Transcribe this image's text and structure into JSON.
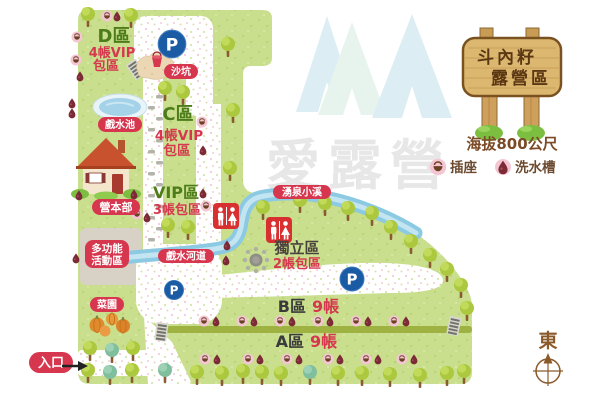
{
  "map": {
    "zone_d": {
      "name": "D區",
      "line1": "4帳VIP",
      "line2": "包區"
    },
    "zone_c": {
      "name": "C區",
      "line1": "4帳VIP",
      "line2": "包區"
    },
    "zone_vip": {
      "name": "VIP區",
      "line1": "3帳包區"
    },
    "zone_indep": {
      "name": "獨立區",
      "line1": "2帳包區"
    },
    "zone_b": {
      "name": "B區",
      "count": "9帳"
    },
    "zone_a": {
      "name": "A區",
      "count": "9帳"
    },
    "labels": {
      "sandpit": "沙坑",
      "pool": "戲水池",
      "hq": "營本部",
      "multi_line1": "多功能",
      "multi_line2": "活動區",
      "garden": "菜園",
      "entrance": "入口",
      "spring_stream": "湧泉小溪",
      "water_channel": "戲水河道"
    },
    "parking": "P"
  },
  "sign": {
    "line1": "斗內籽",
    "line2": "露營區"
  },
  "info": {
    "elevation": "海拔800公尺",
    "legend_outlet": "插座",
    "legend_sink": "洗水槽"
  },
  "compass": {
    "label": "東"
  },
  "watermark": {
    "text": "愛露營"
  },
  "colors": {
    "map_green": "#C9DF8E",
    "road_white": "#FFFFFF",
    "water_blue": "#8CC9E2",
    "label_red": "#D6374F",
    "zone_text_green": "#4D7C1A",
    "parking_blue": "#1B5BA4",
    "restroom_red": "#D83030",
    "sign_wood": "#DCB76F",
    "legend_brown": "#7B4A26",
    "watermark_gray": "#E7E7E7",
    "tent_watermark": "#DCEEF4"
  }
}
